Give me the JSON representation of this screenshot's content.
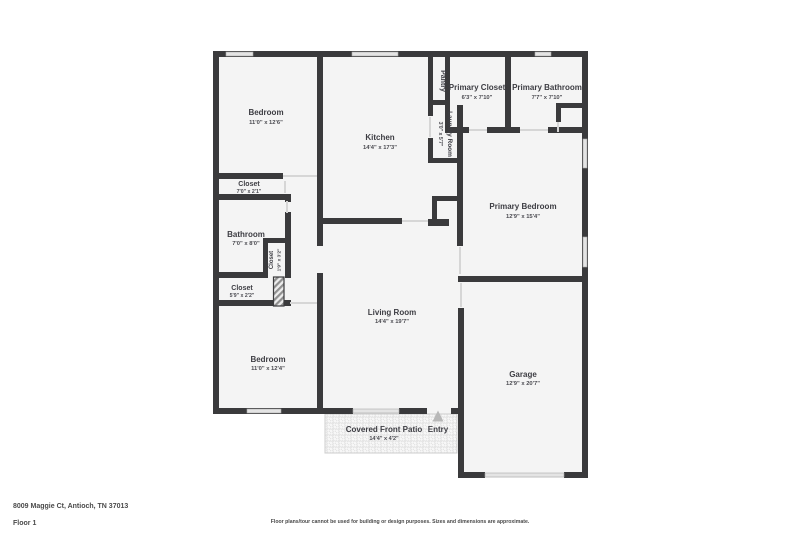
{
  "plan": {
    "rooms": {
      "bedroom_top": {
        "name": "Bedroom",
        "dims": "11'0\" x 12'6\""
      },
      "kitchen": {
        "name": "Kitchen",
        "dims": "14'4\" x 17'3\""
      },
      "pantry": {
        "name": "Pantry",
        "dims": ""
      },
      "primary_closet": {
        "name": "Primary Closet",
        "dims": "6'3\" x 7'10\""
      },
      "primary_bathroom": {
        "name": "Primary Bathroom",
        "dims": "7'7\" x 7'10\""
      },
      "laundry": {
        "name": "Laundry Room",
        "dims": "3'0\" x 5'7\""
      },
      "closet_hall": {
        "name": "Closet",
        "dims": "7'0\" x 2'1\""
      },
      "bathroom": {
        "name": "Bathroom",
        "dims": "7'0\" x 8'0\""
      },
      "closet_small": {
        "name": "Closet",
        "dims": "1'9\" x 3'2\""
      },
      "closet_lower": {
        "name": "Closet",
        "dims": "5'9\" x 2'2\""
      },
      "primary_bedroom": {
        "name": "Primary Bedroom",
        "dims": "12'9\" x 15'4\""
      },
      "bedroom_bottom": {
        "name": "Bedroom",
        "dims": "11'0\" x 12'4\""
      },
      "living_room": {
        "name": "Living Room",
        "dims": "14'4\" x 19'7\""
      },
      "garage": {
        "name": "Garage",
        "dims": "12'9\" x 20'7\""
      },
      "patio": {
        "name": "Covered Front Patio",
        "dims": "14'4\" x 4'2\""
      },
      "entry": {
        "name": "Entry",
        "dims": ""
      }
    },
    "colors": {
      "wall": "#3a3a3c",
      "room_fill": "#f4f4f4",
      "window": "#e4e4e4",
      "label_text": "#3d3d43",
      "entry_arrow": "#b8b8b8"
    }
  },
  "footer": {
    "address": "8009 Maggie Ct, Antioch, TN 37013",
    "floor": "Floor 1",
    "disclaimer": "Floor plans/tour cannot be used for building or design purposes. Sizes and dimensions are approximate."
  }
}
